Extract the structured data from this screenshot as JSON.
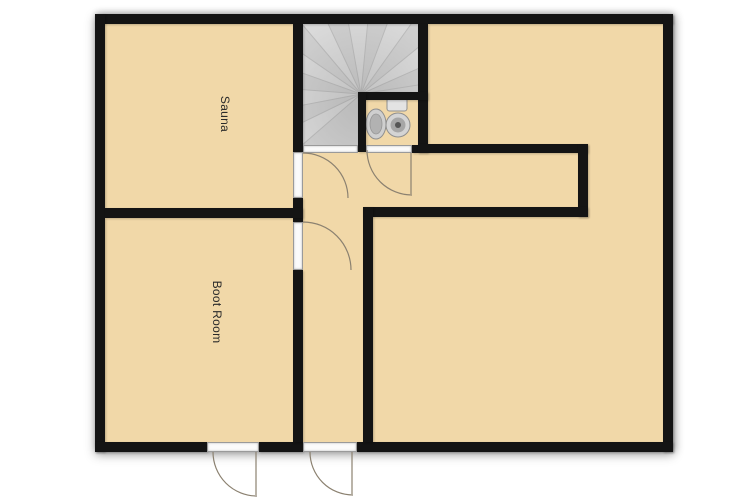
{
  "floor_plan": {
    "rooms": [
      {
        "name": "sauna",
        "label": "Sauna"
      },
      {
        "name": "boot-room",
        "label": "Boot Room"
      }
    ],
    "fixtures": [
      {
        "name": "winder-staircase"
      },
      {
        "name": "toilet"
      },
      {
        "name": "sink"
      }
    ],
    "doors": [
      {
        "name": "sauna-door"
      },
      {
        "name": "boot-room-door"
      },
      {
        "name": "wc-door"
      },
      {
        "name": "exterior-door-left"
      },
      {
        "name": "exterior-door-right"
      }
    ],
    "colors": {
      "background": "#ffffff",
      "wall": "#141414",
      "floor": "#f1d8a8",
      "stairs": "#dcdcdc",
      "door_arc": "#8b8170"
    }
  }
}
